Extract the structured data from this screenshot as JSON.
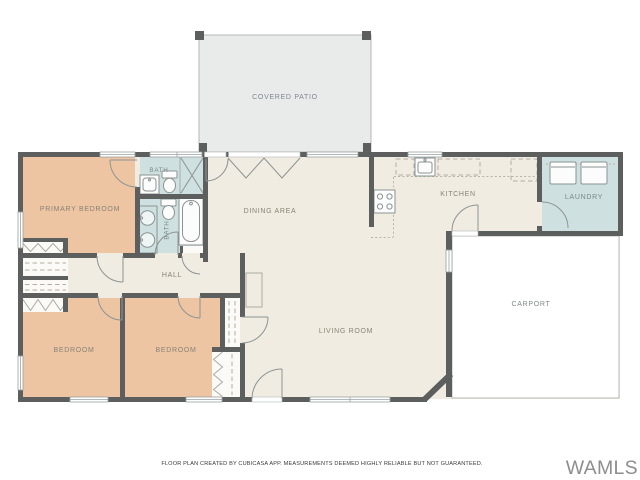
{
  "plan": {
    "rooms": {
      "covered_patio": {
        "label": "COVERED PATIO"
      },
      "primary_bedroom": {
        "label": "PRIMARY BEDROOM"
      },
      "bath_upper": {
        "label": "BATH"
      },
      "bath_lower": {
        "label": "BATH"
      },
      "dining_area": {
        "label": "DINING AREA"
      },
      "kitchen": {
        "label": "KITCHEN"
      },
      "laundry": {
        "label": "LAUNDRY"
      },
      "carport": {
        "label": "CARPORT"
      },
      "living_room": {
        "label": "LIVING ROOM"
      },
      "hall": {
        "label": "HALL"
      },
      "bedroom_left": {
        "label": "BEDROOM"
      },
      "bedroom_center": {
        "label": "BEDROOM"
      }
    },
    "footer": "FLOOR PLAN CREATED BY CUBICASA APP. MEASUREMENTS DEEMED HIGHLY RELIABLE BUT NOT GUARANTEED.",
    "watermark": "WAMLS",
    "colors": {
      "wall": "#5d5f5f",
      "floor_cream": "#f0ece2",
      "bedroom_tan": "#edc5a3",
      "bath_teal": "#cfe0e0",
      "patio_gray": "#e9eaea",
      "carport_white": "#ffffff",
      "label_gray": "#8a8376"
    }
  }
}
